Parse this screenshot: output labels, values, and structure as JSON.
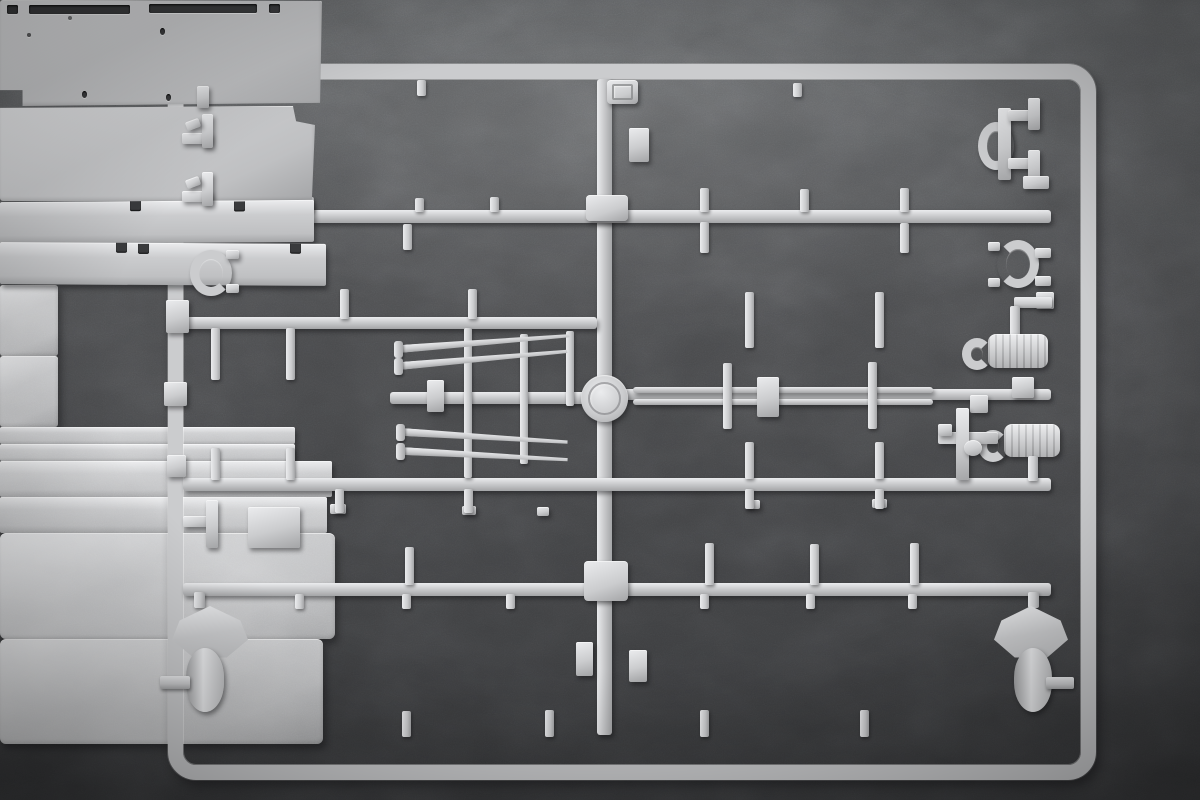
{
  "scene": {
    "type": "photograph",
    "subject": "injection-molded plastic model kit sprue (parts runner)",
    "plastic_material": "light gray styrene",
    "background_surface": "dark gray mottled stone / concrete",
    "orientation": "rectangular sprue frame nearly filling the image, slight perspective"
  },
  "colors": {
    "bg-top": "#5e6062",
    "bg-mid": "#4a4b4d",
    "bg-low": "#353638",
    "plastic": "#cbccce",
    "plastic-hi": "#ebecee",
    "plastic-md": "#bfc0c2",
    "plastic-lo": "#a4a5a7",
    "hole": "#3a3b3d",
    "shadow": "rgba(18,18,20,0.45)"
  },
  "markings": {
    "letter_tab": "small embossed plaque on top runner right of center, lettering illegible",
    "center_boss": "round mold boss at runner crossing with faint embossed ring"
  },
  "parts": [
    {
      "id": "frame",
      "description": "outer rectangular runner frame with rounded corners"
    },
    {
      "id": "center-runner",
      "description": "central vertical runner splitting sprue into halves"
    },
    {
      "id": "cross-runners",
      "description": "four horizontal runners joining the side rails"
    },
    {
      "id": "top-left-panel",
      "description": "large flat rectangular panel, upper left"
    },
    {
      "id": "top-right-panel",
      "description": "large flat rectangular panel with small holes, upper right"
    },
    {
      "id": "left-strip-row2",
      "description": "long narrow strip with two edge notches"
    },
    {
      "id": "right-strip-row2",
      "description": "long narrow strip with two edge notches"
    },
    {
      "id": "small-boxes",
      "description": "two small rectangular box panels, middle left"
    },
    {
      "id": "tapered-masts",
      "description": "four tapered pole/mast parts with flat base caps, center"
    },
    {
      "id": "ladder-rails",
      "description": "two slotted flat rails with two thin rods, middle right"
    },
    {
      "id": "hooked-cylinders",
      "description": "two ribbed cylindrical drums with C-hooks, right side"
    },
    {
      "id": "valve-cross-part",
      "description": "small cross-shaped fitting with round knob, right side"
    },
    {
      "id": "left-strip-row4",
      "description": "long stepped strip with small top tabs"
    },
    {
      "id": "right-strip-row4",
      "description": "long flat strip with small top tabs"
    },
    {
      "id": "bottom-left-panel",
      "description": "large rectangular panel with right edge tab"
    },
    {
      "id": "bottom-right-panel",
      "description": "large rectangular panel with left edge tab"
    },
    {
      "id": "spade-roller-left",
      "description": "shield/spade-shaped part with oval roller below, bottom left"
    },
    {
      "id": "spade-roller-right",
      "description": "shield/spade-shaped part with oval roller below, bottom right"
    },
    {
      "id": "horseshoe-brackets",
      "description": "two C-shaped horseshoe brackets on left and right rails"
    },
    {
      "id": "top-right-bracket",
      "description": "stepped bracket assembly on upper right rail"
    },
    {
      "id": "rail-clips",
      "description": "small clip parts on upper left rail"
    }
  ]
}
